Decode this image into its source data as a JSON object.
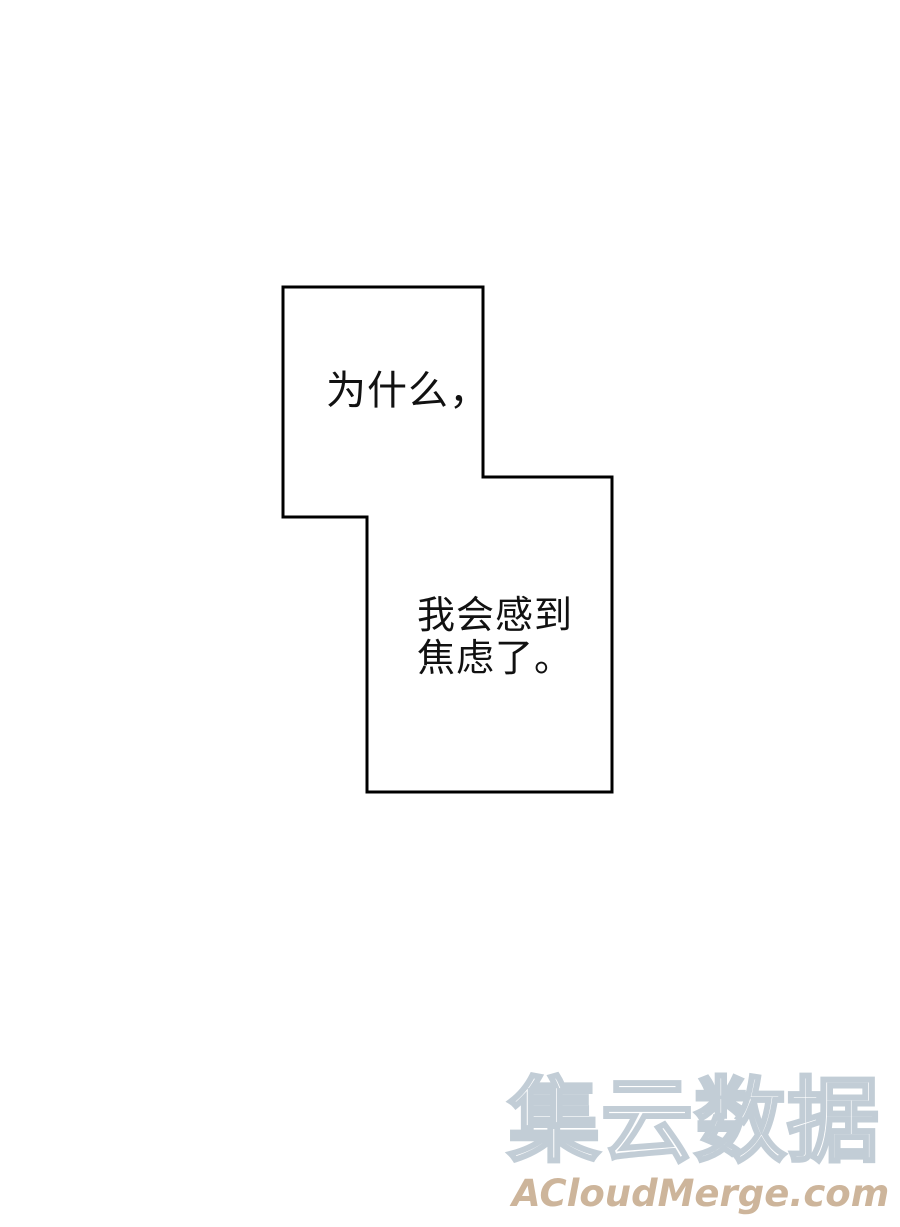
{
  "page": {
    "background_color": "#ffffff",
    "width": 900,
    "height": 1227
  },
  "speech": {
    "bubble_outline_color": "#000000",
    "bubble_fill_color": "#ffffff",
    "bubble1_text": "为什么，",
    "bubble2_lines": [
      "我会感到",
      "焦虑了。"
    ]
  },
  "watermark": {
    "cn_text": "集云数据",
    "cn_fill_color": "#ffffff",
    "cn_outline_color": "#c2cdd6",
    "site_text": "ACloudMerge.com",
    "site_color": "#cdb59b"
  }
}
